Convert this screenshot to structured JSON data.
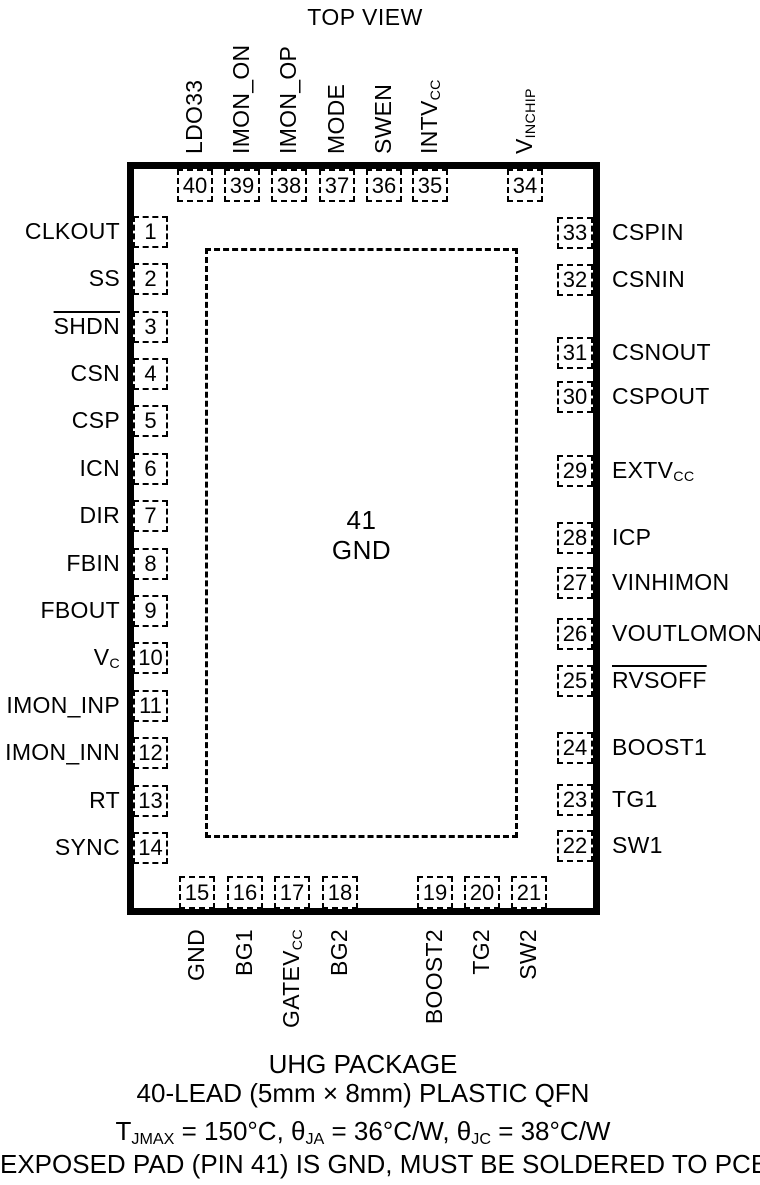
{
  "title": "TOP VIEW",
  "colors": {
    "ink": "#000000",
    "background": "#ffffff"
  },
  "package": {
    "center_pad": {
      "number": "41",
      "label": "GND"
    }
  },
  "pins": {
    "top": [
      {
        "num": "40",
        "x": 195,
        "label": [
          {
            "t": "LDO33"
          }
        ]
      },
      {
        "num": "39",
        "x": 242,
        "label": [
          {
            "t": "IMON_ON"
          }
        ]
      },
      {
        "num": "38",
        "x": 289,
        "label": [
          {
            "t": "IMON_OP"
          }
        ]
      },
      {
        "num": "37",
        "x": 337,
        "label": [
          {
            "t": "MODE"
          }
        ]
      },
      {
        "num": "36",
        "x": 384,
        "label": [
          {
            "t": "SWEN"
          }
        ]
      },
      {
        "num": "35",
        "x": 430,
        "label": [
          {
            "t": "INTV"
          },
          {
            "s": "CC"
          }
        ]
      },
      {
        "num": "34",
        "x": 525,
        "label": [
          {
            "t": "V"
          },
          {
            "s": "INCHIP"
          }
        ]
      }
    ],
    "left": [
      {
        "num": "1",
        "y": 232,
        "label": [
          {
            "t": "CLKOUT"
          }
        ]
      },
      {
        "num": "2",
        "y": 279,
        "label": [
          {
            "t": "SS"
          }
        ]
      },
      {
        "num": "3",
        "y": 327,
        "label": [
          {
            "t": "SHDN",
            "o": true
          }
        ]
      },
      {
        "num": "4",
        "y": 374,
        "label": [
          {
            "t": "CSN"
          }
        ]
      },
      {
        "num": "5",
        "y": 421,
        "label": [
          {
            "t": "CSP"
          }
        ]
      },
      {
        "num": "6",
        "y": 469,
        "label": [
          {
            "t": "ICN"
          }
        ]
      },
      {
        "num": "7",
        "y": 516,
        "label": [
          {
            "t": "DIR"
          }
        ]
      },
      {
        "num": "8",
        "y": 564,
        "label": [
          {
            "t": "FBIN"
          }
        ]
      },
      {
        "num": "9",
        "y": 611,
        "label": [
          {
            "t": "FBOUT"
          }
        ]
      },
      {
        "num": "10",
        "y": 658,
        "label": [
          {
            "t": "V"
          },
          {
            "s": "C"
          }
        ]
      },
      {
        "num": "11",
        "y": 706,
        "label": [
          {
            "t": "IMON_INP"
          }
        ]
      },
      {
        "num": "12",
        "y": 753,
        "label": [
          {
            "t": "IMON_INN"
          }
        ]
      },
      {
        "num": "13",
        "y": 801,
        "label": [
          {
            "t": "RT"
          }
        ]
      },
      {
        "num": "14",
        "y": 848,
        "label": [
          {
            "t": "SYNC"
          }
        ]
      }
    ],
    "right": [
      {
        "num": "33",
        "y": 233,
        "label": [
          {
            "t": "CSPIN"
          }
        ]
      },
      {
        "num": "32",
        "y": 280,
        "label": [
          {
            "t": "CSNIN"
          }
        ]
      },
      {
        "num": "31",
        "y": 353,
        "label": [
          {
            "t": "CSNOUT"
          }
        ]
      },
      {
        "num": "30",
        "y": 397,
        "label": [
          {
            "t": "CSPOUT"
          }
        ]
      },
      {
        "num": "29",
        "y": 471,
        "label": [
          {
            "t": "EXTV"
          },
          {
            "s": "CC"
          }
        ]
      },
      {
        "num": "28",
        "y": 538,
        "label": [
          {
            "t": "ICP"
          }
        ]
      },
      {
        "num": "27",
        "y": 583,
        "label": [
          {
            "t": "VINHIMON"
          }
        ]
      },
      {
        "num": "26",
        "y": 634,
        "label": [
          {
            "t": "VOUTLOMON"
          }
        ]
      },
      {
        "num": "25",
        "y": 681,
        "label": [
          {
            "t": "RVSOFF",
            "o": true
          }
        ]
      },
      {
        "num": "24",
        "y": 748,
        "label": [
          {
            "t": "BOOST1"
          }
        ]
      },
      {
        "num": "23",
        "y": 800,
        "label": [
          {
            "t": "TG1"
          }
        ]
      },
      {
        "num": "22",
        "y": 846,
        "label": [
          {
            "t": "SW1"
          }
        ]
      }
    ],
    "bottom": [
      {
        "num": "15",
        "x": 197,
        "label": [
          {
            "t": "GND"
          }
        ]
      },
      {
        "num": "16",
        "x": 245,
        "label": [
          {
            "t": "BG1"
          }
        ]
      },
      {
        "num": "17",
        "x": 292,
        "label": [
          {
            "t": "GATEV"
          },
          {
            "s": "CC"
          }
        ]
      },
      {
        "num": "18",
        "x": 340,
        "label": [
          {
            "t": "BG2"
          }
        ]
      },
      {
        "num": "19",
        "x": 435,
        "label": [
          {
            "t": "BOOST2"
          }
        ]
      },
      {
        "num": "20",
        "x": 482,
        "label": [
          {
            "t": "TG2"
          }
        ]
      },
      {
        "num": "21",
        "x": 529,
        "label": [
          {
            "t": "SW2"
          }
        ]
      }
    ]
  },
  "caption": {
    "line1": "UHG PACKAGE",
    "line2": "40-LEAD (5mm × 8mm) PLASTIC QFN",
    "line3": [
      {
        "t": "T"
      },
      {
        "s": "JMAX"
      },
      {
        "t": " = 150°C, θ"
      },
      {
        "s": "JA"
      },
      {
        "t": " = 36°C/W, θ"
      },
      {
        "s": "JC"
      },
      {
        "t": " = 38°C/W"
      }
    ],
    "line4": "EXPOSED PAD (PIN 41) IS GND, MUST BE SOLDERED TO PCB"
  }
}
